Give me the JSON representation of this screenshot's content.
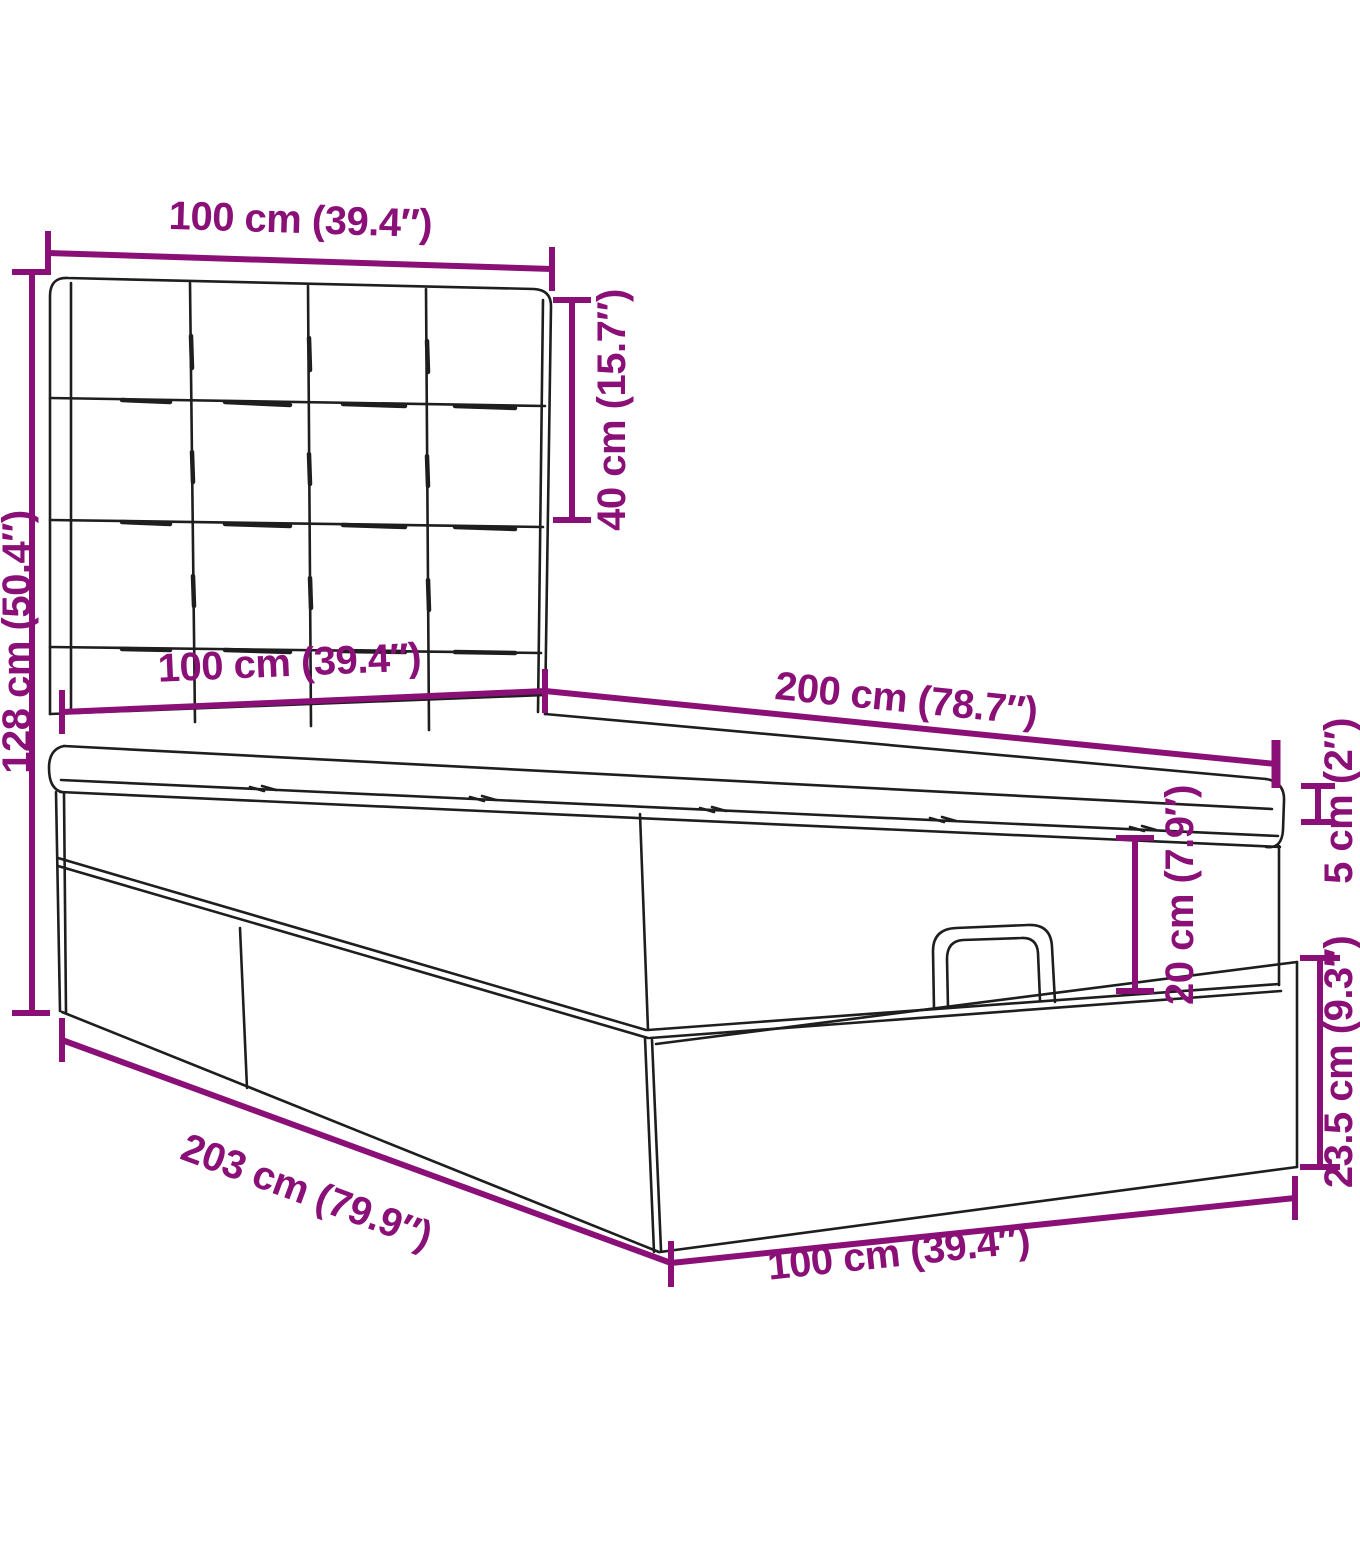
{
  "figure": {
    "title": "Ottoman storage bed with tufted headboard — dimension diagram",
    "type": "product-dimension-drawing"
  },
  "colors": {
    "dimension": "#8A1078",
    "line_art": "#1e1e1e",
    "background": "#ffffff"
  },
  "dims": {
    "headboard_width": {
      "label": "100 cm (39.4″)"
    },
    "headboard_height": {
      "label": "40 cm (15.7″)"
    },
    "total_height": {
      "label": "128 cm (50.4″)"
    },
    "mattress_width": {
      "label": "100 cm (39.4″)"
    },
    "bed_length": {
      "label": "200 cm (78.7″)"
    },
    "topper_height": {
      "label": "5 cm (2″)"
    },
    "box_height": {
      "label": "20 cm (7.9″)"
    },
    "base_height": {
      "label": "23.5 cm (9.3″)"
    },
    "base_length": {
      "label": "203 cm (79.9″)"
    },
    "base_width": {
      "label": "100 cm (39.4″)"
    }
  }
}
